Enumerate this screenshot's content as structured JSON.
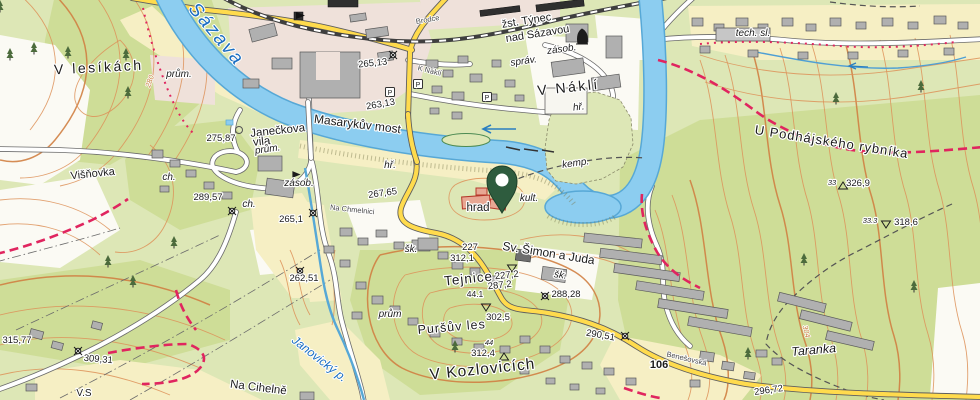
{
  "colors": {
    "water": "#8ccdf0",
    "water_edge": "#57a8d6",
    "forest": "#cedd97",
    "meadow": "#f6efc4",
    "urban": "#efe1da",
    "contour": "#dd9058",
    "road_yellow": "#ffdb4d",
    "trail_red": "#e0255f",
    "pin_green": "#2e5c3e"
  },
  "labels": {
    "water": {
      "sazava": "Sázava",
      "janovicky": "Janovický p."
    },
    "places": {
      "v_lesikach": "V lesíkách",
      "v_nakli": "V Náklí",
      "u_podhajskeho": "U Podhájského rybníka",
      "tejnice": "Tejnice",
      "pursuv_les": "Puršův les",
      "v_kozlovicich": "V Kozlovicích",
      "taranka": "Taranka",
      "visnovka": "Višňovka",
      "na_cihelne": "Na Cihelně",
      "vs": "V.S",
      "masarykuv_most": "Masarykův most",
      "sv_simon": "Sv. Šimon a Juda",
      "hrad": "hrad",
      "janeckova_1": "Janečkova",
      "janeckova_2": "vila"
    },
    "station": {
      "line1": "žst. Týnec",
      "line2": "nad Sázavou"
    },
    "small": {
      "kemp": "kemp.",
      "sprav": "správ.",
      "zasob_st": "zásob.",
      "zasob_w": "zásob.",
      "kult": "kult.",
      "hr_nakli": "hř.",
      "hr_w": "hř.",
      "sk_1": "šk.",
      "sk_2": "šk.",
      "prum_1": "prům.",
      "prum_2": "prům.",
      "prum_3": "prům",
      "ch_1": "ch.",
      "ch_2": "ch.",
      "tech_sl": "tech. sl."
    },
    "streets": {
      "brodce": "Brodce",
      "k_nakli": "K Náklí",
      "na_chmelnici": "Na Chmelnici",
      "benesovska": "Benešovská"
    }
  },
  "elevations": {
    "e265_13": "265,13",
    "e263_13": "263,13",
    "e275_87": "275,87",
    "e267_65": "267,65",
    "e289_57": "289,57",
    "e265_1": "265,1",
    "e262_51": "262,51",
    "e309_31": "309,31",
    "e315_77": "315,77",
    "e302_5": "302,5",
    "e312_4": "312,4",
    "e44": "44",
    "e44_1": "44.1",
    "e287_2": "287,2",
    "e227_2": "227,2",
    "e227": "227",
    "e312_1": "312,1",
    "e288_28": "288,28",
    "e290_51": "290,51",
    "e296_72": "296,72",
    "e326_9": "326,9",
    "e33": "33",
    "e318_6": "318,6",
    "e33_3": "33.3"
  },
  "contour_labels": {
    "c304": "304",
    "c280": "280"
  },
  "road_badge": "106",
  "symbols": {
    "parking": "P"
  }
}
